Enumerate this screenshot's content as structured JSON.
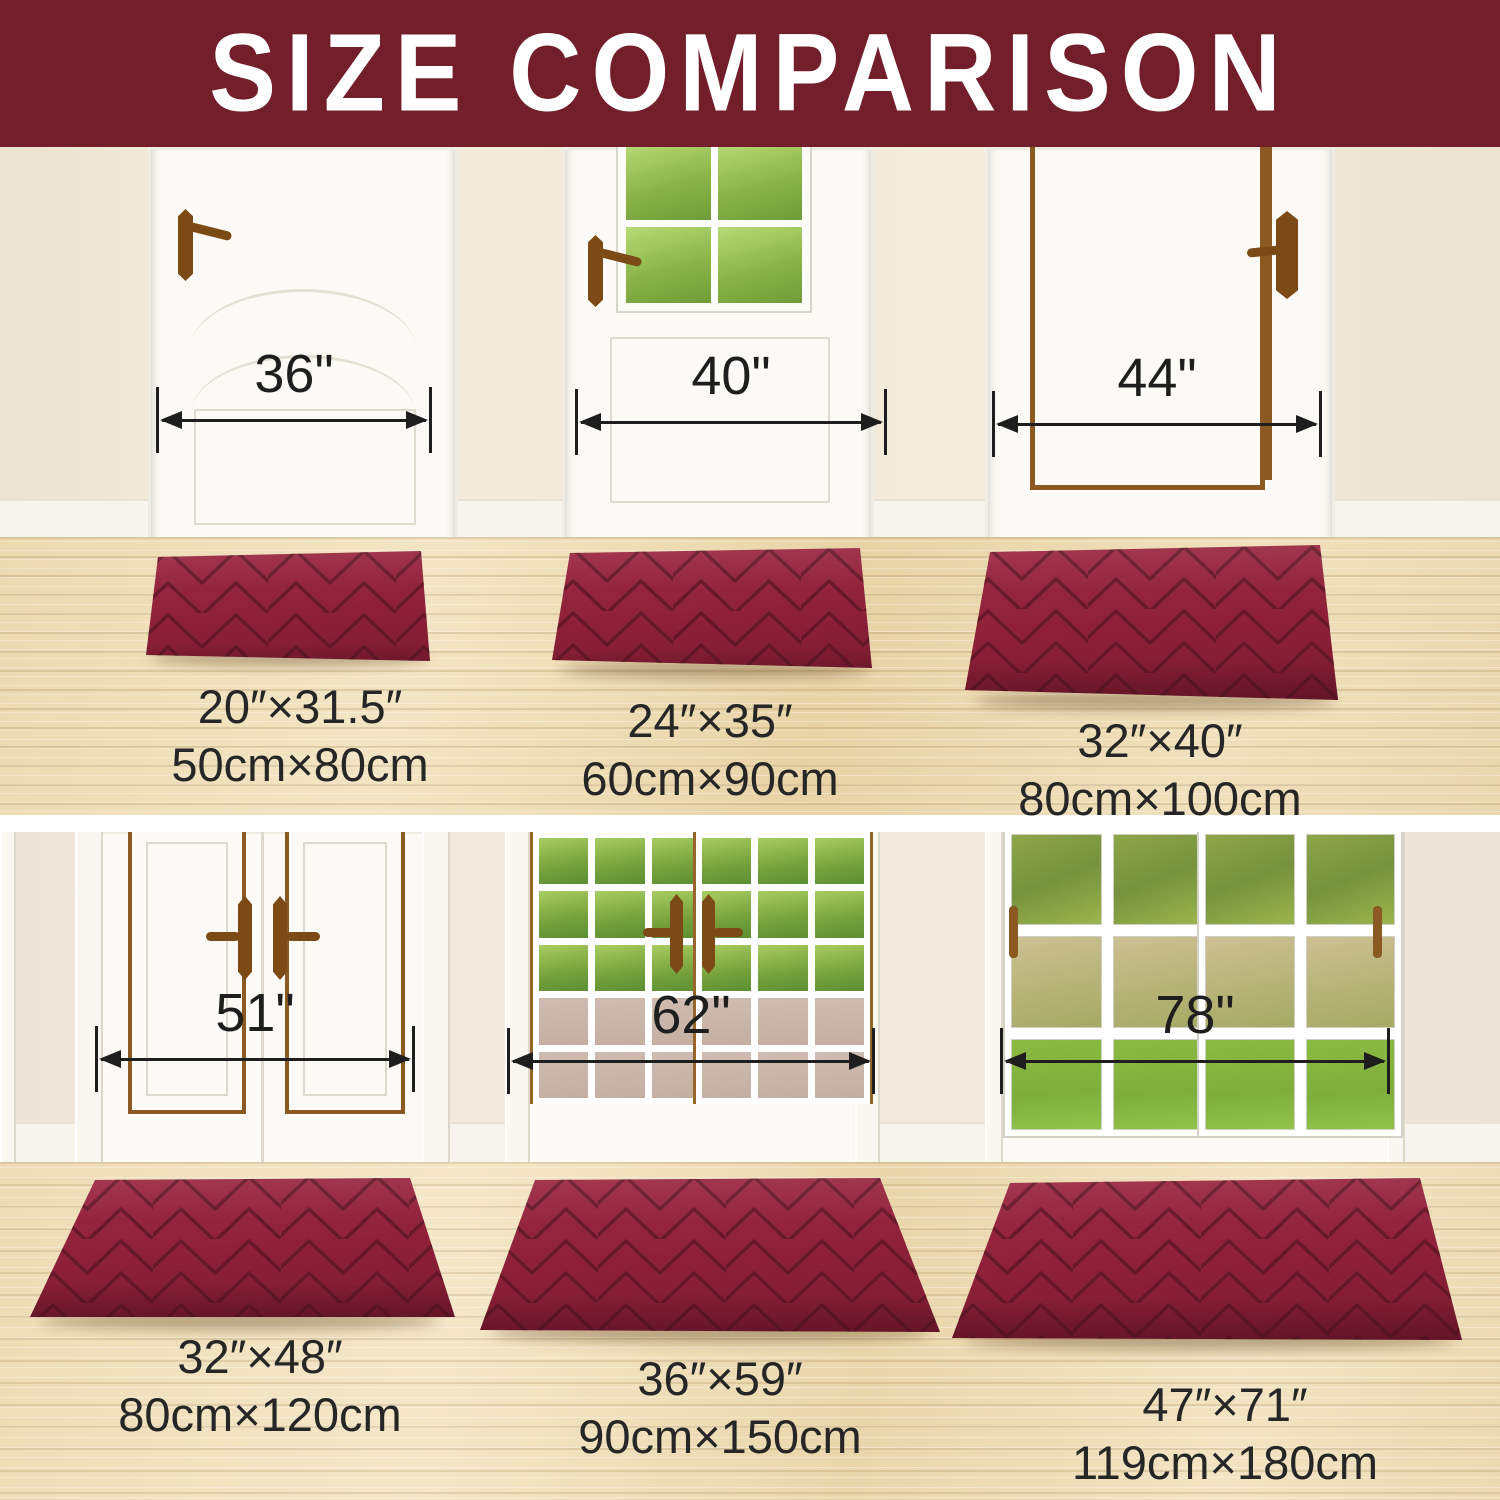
{
  "title": "SIZE COMPARISON",
  "banner_color": "#731f2b",
  "mat_color": "#8e2139",
  "measure_color": "#1e1e1e",
  "door_measurements": [
    "36\"",
    "40\"",
    "44\"",
    "51\"",
    "62\"",
    "78\""
  ],
  "mat_sizes": [
    {
      "inches": "20″×31.5″",
      "metric": "50cm×80cm"
    },
    {
      "inches": "24″×35″",
      "metric": "60cm×90cm"
    },
    {
      "inches": "32″×40″",
      "metric": "80cm×100cm"
    },
    {
      "inches": "32″×48″",
      "metric": "80cm×120cm"
    },
    {
      "inches": "36″×59″",
      "metric": "90cm×150cm"
    },
    {
      "inches": "47″×71″",
      "metric": "119cm×180cm"
    }
  ]
}
